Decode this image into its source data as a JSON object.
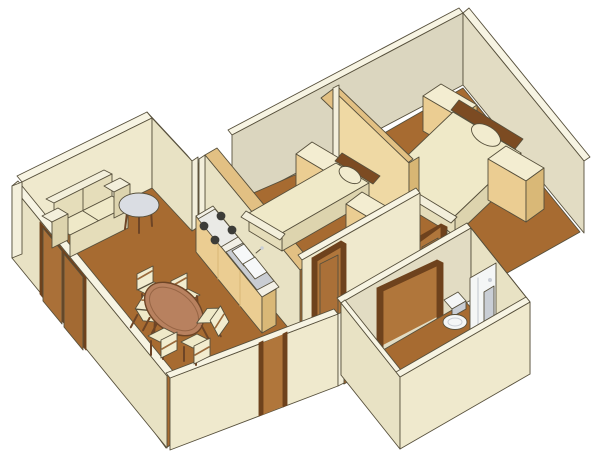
{
  "image": {
    "kind": "3d-isometric-apartment-floor-plan-rendering",
    "canvas": {
      "width": 600,
      "height": 470
    },
    "view": "cutaway axonometric view from above, white background, no visible text"
  },
  "colors": {
    "bg": "#FFFFFF",
    "outline": "#57503C",
    "wallTop": "#F7F4E3",
    "wallInt": "#DBD6BF",
    "wallInt2": "#E2DCC3",
    "wallSW": "#E8E2C4",
    "wallSE": "#EFE9CD",
    "wallLight": "#F3EFDB",
    "floor": "#A76B31",
    "floorBright": "#B0763B",
    "tanTop": "#E2C083",
    "tanFace": "#EFD9A4",
    "tanSide": "#D8B674",
    "cabinetTop": "#F3EDD1",
    "cabinetFront": "#EBCD92",
    "cabinetSide": "#D9B877",
    "bedSpread": "#EFE9C8",
    "bedSide": "#E5DDBA",
    "bedSide2": "#DDD4AE",
    "bedRim": "#7C4B22",
    "pillow": "#F2ECCF",
    "counterTop": "#F2F0E6",
    "stoveBody": "#EAEAE6",
    "burner": "#3C3C38",
    "sinkRim": "#C9CDD3",
    "sinkBasin": "#F6F8F9",
    "wood": "#9A6A3C",
    "woodDark": "#6E4526",
    "tableTop": "#B8815F",
    "doorPanel": "#AA7038",
    "doorPanel2": "#A36A33",
    "doorFrame": "#6E421D",
    "grayTop": "#DADDE3",
    "fixtureWhite": "#F4F6F6",
    "fixtureGray": "#C9CED5"
  },
  "scene": {
    "rooms": [
      {
        "id": "living-dining",
        "label": "living-dining-room",
        "furniture": [
          "loveseat-sofa",
          "round-side-table",
          "oval-dining-table",
          "dining-chair x6",
          "sliding-closet-doors x2"
        ]
      },
      {
        "id": "kitchen",
        "label": "kitchen",
        "furniture": [
          "counter-with-cabinets",
          "cooktop-4-burners",
          "double-basin-sink"
        ]
      },
      {
        "id": "bedroom-small",
        "label": "small-bedroom",
        "furniture": [
          "single-bed",
          "pillow",
          "nightstand",
          "dresser",
          "door-to-hallway"
        ]
      },
      {
        "id": "bedroom-large",
        "label": "large-bedroom",
        "furniture": [
          "double-bed",
          "pillow",
          "nightstand",
          "dresser",
          "wood-partition-wall",
          "door-to-hallway"
        ]
      },
      {
        "id": "hallway",
        "label": "hallway",
        "furniture": [
          "open-doorway"
        ]
      },
      {
        "id": "bathroom",
        "label": "bathroom",
        "furniture": [
          "toilet",
          "shower-panel",
          "mirror-panel",
          "door-frame"
        ]
      }
    ]
  }
}
